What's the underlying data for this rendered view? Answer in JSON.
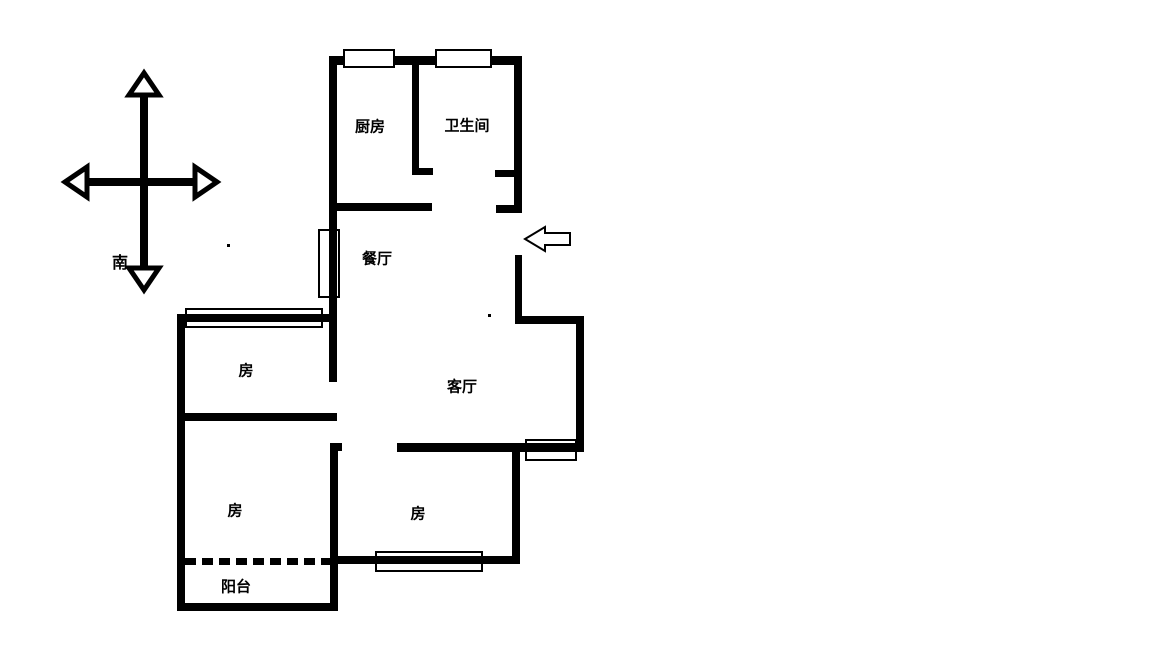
{
  "compass": {
    "south_label": "南"
  },
  "plan": {
    "wall_color": "#000000",
    "background": "#ffffff",
    "rooms": [
      {
        "name": "kitchen",
        "label": "厨房",
        "cx": 370,
        "cy": 127
      },
      {
        "name": "bathroom",
        "label": "卫生间",
        "cx": 467,
        "cy": 126
      },
      {
        "name": "dining-room",
        "label": "餐厅",
        "cx": 377,
        "cy": 259
      },
      {
        "name": "living-room",
        "label": "客厅",
        "cx": 462,
        "cy": 387
      },
      {
        "name": "bedroom-north",
        "label": "房",
        "cx": 246,
        "cy": 371
      },
      {
        "name": "bedroom-south",
        "label": "房",
        "cx": 235,
        "cy": 511
      },
      {
        "name": "bedroom-middle",
        "label": "房",
        "cx": 418,
        "cy": 514
      },
      {
        "name": "balcony",
        "label": "阳台",
        "cx": 236,
        "cy": 587
      }
    ],
    "walls": [
      {
        "name": "wall-north",
        "x": 330,
        "y": 56,
        "w": 191,
        "h": 9
      },
      {
        "name": "wall-west-upper",
        "x": 329,
        "y": 56,
        "w": 8,
        "h": 326
      },
      {
        "name": "wall-kitchen-south",
        "x": 329,
        "y": 203,
        "w": 103,
        "h": 8
      },
      {
        "name": "wall-kitchen-bath-divider",
        "x": 412,
        "y": 62,
        "w": 7,
        "h": 113
      },
      {
        "name": "wall-divider-foot",
        "x": 412,
        "y": 168,
        "w": 21,
        "h": 7
      },
      {
        "name": "wall-bath-east",
        "x": 514,
        "y": 56,
        "w": 8,
        "h": 157
      },
      {
        "name": "wall-bath-door-jamb",
        "x": 495,
        "y": 170,
        "w": 19,
        "h": 7
      },
      {
        "name": "wall-entry-jamb-upper",
        "x": 496,
        "y": 205,
        "w": 26,
        "h": 8
      },
      {
        "name": "wall-entry-jamb-lower",
        "x": 515,
        "y": 255,
        "w": 7,
        "h": 69
      },
      {
        "name": "wall-east-mid-horizontal",
        "x": 515,
        "y": 316,
        "w": 68,
        "h": 8
      },
      {
        "name": "wall-east-outer",
        "x": 576,
        "y": 316,
        "w": 8,
        "h": 136
      },
      {
        "name": "wall-living-south",
        "x": 397,
        "y": 443,
        "w": 187,
        "h": 9
      },
      {
        "name": "wall-hall-jamb",
        "x": 330,
        "y": 443,
        "w": 12,
        "h": 8
      },
      {
        "name": "wall-west-mid-vertical",
        "x": 330,
        "y": 443,
        "w": 8,
        "h": 168
      },
      {
        "name": "wall-bedroom-middle-south",
        "x": 334,
        "y": 556,
        "w": 184,
        "h": 8
      },
      {
        "name": "wall-bedroom-middle-east",
        "x": 512,
        "y": 452,
        "w": 8,
        "h": 112
      },
      {
        "name": "wall-bedroom-north-top",
        "x": 178,
        "y": 314,
        "w": 153,
        "h": 8
      },
      {
        "name": "wall-west-outer",
        "x": 177,
        "y": 314,
        "w": 8,
        "h": 297
      },
      {
        "name": "wall-bedrooms-divider",
        "x": 177,
        "y": 413,
        "w": 160,
        "h": 8
      },
      {
        "name": "wall-balcony-south",
        "x": 177,
        "y": 603,
        "w": 161,
        "h": 8
      }
    ],
    "windows": [
      {
        "name": "kitchen-window",
        "x": 343,
        "y": 49,
        "w": 52,
        "h": 19,
        "filled": true
      },
      {
        "name": "bathroom-window",
        "x": 435,
        "y": 49,
        "w": 57,
        "h": 19,
        "filled": true
      },
      {
        "name": "dining-window",
        "x": 318,
        "y": 229,
        "w": 22,
        "h": 69,
        "filled": false
      },
      {
        "name": "bedroom-north-window",
        "x": 185,
        "y": 308,
        "w": 138,
        "h": 20,
        "filled": false
      },
      {
        "name": "living-window",
        "x": 525,
        "y": 439,
        "w": 52,
        "h": 22,
        "filled": false
      },
      {
        "name": "bedroom-middle-window",
        "x": 375,
        "y": 551,
        "w": 108,
        "h": 21,
        "filled": false
      }
    ],
    "balcony_divider": {
      "x": 185,
      "y": 558,
      "w": 145,
      "h": 7
    },
    "specks": [
      {
        "x": 227,
        "y": 244
      },
      {
        "x": 488,
        "y": 314
      }
    ]
  }
}
